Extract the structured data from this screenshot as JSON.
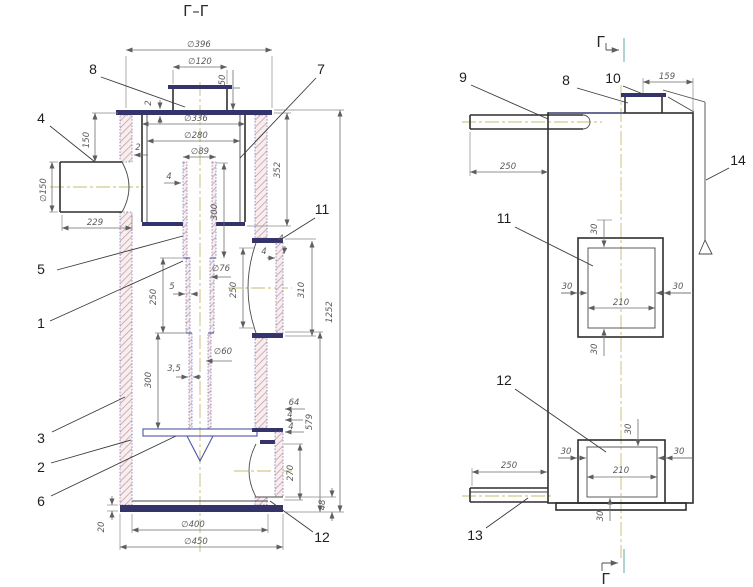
{
  "labels": {
    "section_view_title": "Г–Г",
    "section_cut_letter": "Г"
  },
  "dims": {
    "dia396": "∅396",
    "dia120": "∅120",
    "n50": "50",
    "n2": "2",
    "dia336": "∅336",
    "dia280": "∅280",
    "dia89": "∅89",
    "n150": "150",
    "dia150": "∅150",
    "n229": "229",
    "n4": "4",
    "n300": "300",
    "n352": "352",
    "n250": "250",
    "n5": "5",
    "dia76": "∅76",
    "n310": "310",
    "n1252": "1252",
    "n3_5": "3,5",
    "dia60": "∅60",
    "n64": "64",
    "n579": "579",
    "n270": "270",
    "n48": "48",
    "n20": "20",
    "dia400": "∅400",
    "dia450": "∅450",
    "n159": "159",
    "n30": "30",
    "n210": "210"
  },
  "callouts": {
    "c1": "1",
    "c2": "2",
    "c3": "3",
    "c4": "4",
    "c5": "5",
    "c6": "6",
    "c7": "7",
    "c8": "8",
    "c9": "9",
    "c10": "10",
    "c11": "11",
    "c12": "12",
    "c13": "13",
    "c14": "14"
  },
  "colors": {
    "line": "#2f2f2f",
    "accent_blue": "#5056a8",
    "centerline": "#c6bd72",
    "teal_mark": "#93c6c6",
    "dim_line": "#6e6e6e",
    "hatch_fill": "#cf9d9d"
  }
}
